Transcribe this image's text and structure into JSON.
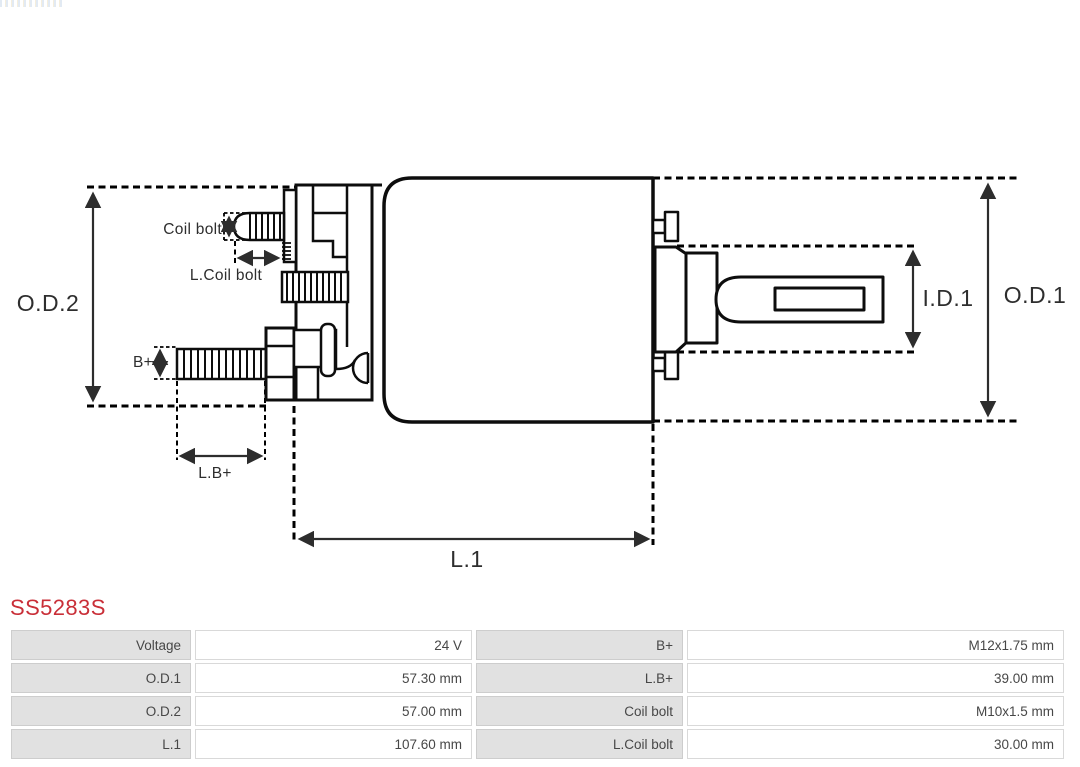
{
  "part_number": "SS5283S",
  "accent_color": "#c92f38",
  "diagram": {
    "labels": {
      "od2": "O.D.2",
      "od1": "O.D.1",
      "id1": "I.D.1",
      "l1": "L.1",
      "coil_bolt": "Coil bolt",
      "l_coil_bolt": "L.Coil bolt",
      "b_plus": "B+",
      "l_b_plus": "L.B+"
    }
  },
  "specs": {
    "rows": [
      {
        "label": "Voltage",
        "value": "24 V",
        "label2": "B+",
        "value2": "M12x1.75 mm"
      },
      {
        "label": "O.D.1",
        "value": "57.30 mm",
        "label2": "L.B+",
        "value2": "39.00 mm"
      },
      {
        "label": "O.D.2",
        "value": "57.00 mm",
        "label2": "Coil bolt",
        "value2": "M10x1.5 mm"
      },
      {
        "label": "L.1",
        "value": "107.60 mm",
        "label2": "L.Coil bolt",
        "value2": "30.00 mm"
      }
    ]
  }
}
